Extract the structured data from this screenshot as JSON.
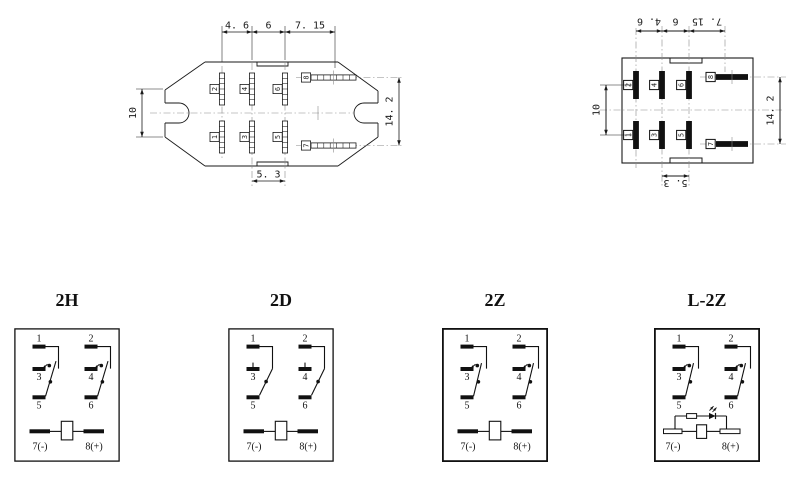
{
  "drawings": {
    "left": {
      "dims": {
        "top": [
          "4. 6",
          "6",
          "7. 15"
        ],
        "left": "10",
        "right": "14. 2",
        "bottom": "5. 3"
      },
      "pins": {
        "top": [
          "2",
          "4",
          "6"
        ],
        "bottom": [
          "1",
          "3",
          "5"
        ],
        "side_top": "8",
        "side_bottom": "7"
      }
    },
    "right": {
      "dims": {
        "top": [
          "4. 6",
          "6",
          "7. 15"
        ],
        "left": "10",
        "right": "14. 2",
        "bottom": "5. 3"
      },
      "pins": {
        "top": [
          "2",
          "4",
          "6"
        ],
        "bottom": [
          "1",
          "3",
          "5"
        ],
        "side_top": "8",
        "side_bottom": "7"
      }
    }
  },
  "schematics": [
    {
      "id": "2H",
      "title": "2H",
      "type": "H",
      "pole1": [
        "1",
        "3",
        "5"
      ],
      "pole2": [
        "2",
        "4",
        "6"
      ],
      "coil_neg": "7(-)",
      "coil_pos": "8(+)"
    },
    {
      "id": "2D",
      "title": "2D",
      "type": "D",
      "pole1": [
        "1",
        "3",
        "5"
      ],
      "pole2": [
        "2",
        "4",
        "6"
      ],
      "coil_neg": "7(-)",
      "coil_pos": "8(+)"
    },
    {
      "id": "2Z",
      "title": "2Z",
      "type": "Z",
      "pole1": [
        "1",
        "3",
        "5"
      ],
      "pole2": [
        "2",
        "4",
        "6"
      ],
      "coil_neg": "7(-)",
      "coil_pos": "8(+)"
    },
    {
      "id": "L-2Z",
      "title": "L-2Z",
      "type": "LZ",
      "pole1": [
        "1",
        "3",
        "5"
      ],
      "pole2": [
        "2",
        "4",
        "6"
      ],
      "coil_neg": "7(-)",
      "coil_pos": "8(+)"
    }
  ],
  "colors": {
    "ink": "#1a1a1a",
    "centerline": "#8a8a8a",
    "background": "#ffffff"
  }
}
